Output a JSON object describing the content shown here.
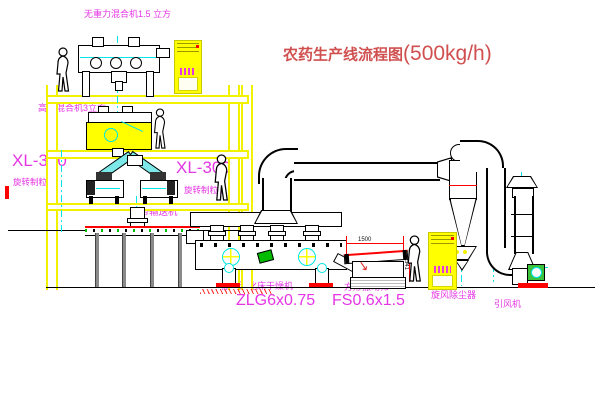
{
  "title": {
    "prefix": "农药生产线流程图",
    "capacity": "(500kg/h)"
  },
  "labels": {
    "top_mixer": "无重力混合机1.5 立方",
    "high_speed_mixer": "高速混合机3立方",
    "granulator_left_model": "XL-300",
    "granulator_left_name": "旋转制粒机",
    "granulator_right_model": "XL-300",
    "granulator_right_name": "旋转制粒机",
    "belt_conveyor": "皮带输送机",
    "dryer_name": "振动流化床干燥机",
    "dryer_model": "ZLG6x0.75",
    "sieve_name": "方形振动筛",
    "sieve_model": "FS0.6x1.5",
    "cyclone": "旋风除尘器",
    "fan": "引风机"
  },
  "dimensions": {
    "cyclone_diameter": "Φ400",
    "sieve_length": "1500",
    "sieve_height": "541"
  },
  "colors": {
    "label_magenta": "#e535e5",
    "title_red": "#d05050",
    "structure_yellow": "#f2f200",
    "centerline_cyan": "#00e5e5",
    "outline_black": "#000000",
    "accent_red": "#ff0000",
    "accent_green": "#00bb00"
  }
}
